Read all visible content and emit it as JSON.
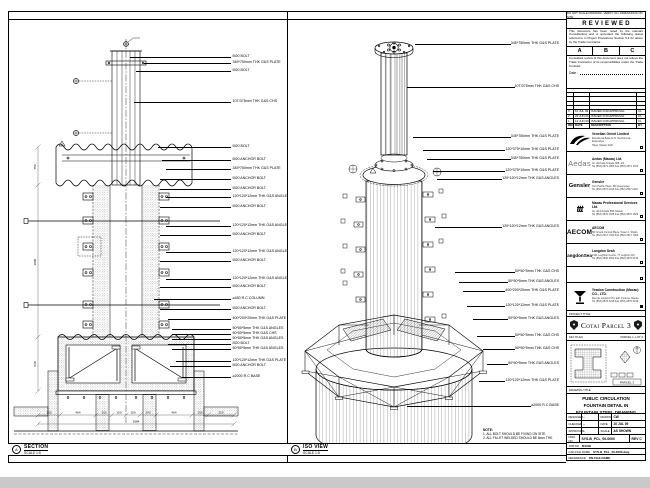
{
  "sheet": {
    "top_note": "DO NOT SCALE DRAWING. VERIFY ALL DIMENSIONS ON SITE.",
    "left_view": {
      "ref": "A",
      "label": "SECTION",
      "scale": "SCALE 1:5",
      "rev_triangle": "3",
      "callouts": [
        "M20 BOLT",
        "345*750mm THK G&S PLATE",
        "M20 BOLT",
        "10T/375mm THK G&S CHS",
        "M20 BOLT",
        "M20 ANCHOR BOLT",
        "345*750mm THK G&S PLATE",
        "M20 ANCHOR BOLT",
        "M20 ANCHOR BOLT",
        "120*120*12mm THK G&S ANGLES",
        "M20 ANCHOR BOLT",
        "120*120*12mm THK G&S ANGLES",
        "M20 ANCHOR BOLT",
        "120*120*12mm THK G&S ANGLES",
        "M20 ANCHOR BOLT",
        "120*120*12mm THK G&S ANGLES",
        "M20 ANCHOR BOLT",
        "⌀450 R.C COLUMN",
        "M20 ANCHOR BOLT",
        "400*200*20mm THK G&S PLATE",
        "50*50*5mm THK G&S ANGLES",
        "50*50*5mm THK G&S CHS",
        "50*50*5mm THK G&S ANGLES",
        "M20 BOLT",
        "50*50*5mm THK G&S ANGLES",
        "120*120*12mm THK G&S PLATE",
        "M20 ANCHOR BOLT",
        "⌀2000 R.C BASE"
      ],
      "dim_bottom": [
        "200",
        "464",
        "200",
        "150",
        "150",
        "200",
        "464",
        "200",
        "250"
      ],
      "dim_total": "2584",
      "dim_side": [
        "750",
        "3000",
        "540"
      ]
    },
    "iso_view": {
      "ref": "B",
      "label": "ISO VIEW",
      "scale": "SCALE 1:5",
      "note_title": "NOTE:",
      "notes": [
        "1. ALL BOLT SHOULD BE FIXING ON SITE.",
        "2. ALL FILLET WELDED SHOULD BE 6mm THK."
      ],
      "callouts": [
        "345*750mm THK G&S PLATE",
        "10T/375mm THK G&S CHS",
        "345*750mm THK G&S PLATE",
        "120*375*10mm THK G&S PLATE",
        "345*750mm THK G&S PLATE",
        "120*375*10mm THK G&S PLATE",
        "120*120*12mm THK G&S ANGLES",
        "120*120*12mm THK G&S ANGLES",
        "50*50*5mm THK G&S CHS",
        "50*50*5mm THK G&S ANGLES",
        "400*200*20mm THK G&S PLATE",
        "120*120*12mm THK G&S PLATE",
        "50*50*5mm THK G&S ANGLES",
        "50*50*5mm THK G&S CHS",
        "50*50*5mm THK G&S CHS",
        "50*50*5mm THK G&S ANGLES",
        "120*120*12mm THK G&S PLATE",
        "⌀2000 R.C BASE"
      ]
    },
    "title_block": {
      "reviewed": {
        "title": "REVIEWED",
        "para1": "This document has been noted by the relevant Consultant(s) and is accorded the following status referred to in Project Procedures Section 5.4 for action by the Trade Contractor.",
        "grades": [
          "A",
          "B",
          "C"
        ],
        "para2": "Consultant review of this document does not relieve the Trade Contractor of its responsibilities under the Trade Contract.",
        "date_label": "Date :"
      },
      "revision_table": {
        "headers": [
          "REV",
          "DATE",
          "DESCRIPTION",
          "BY"
        ],
        "rows": [
          [
            "3",
            "10 JUL 09",
            "ISSUED FOR APPROVAL",
            "CL"
          ],
          [
            "2",
            "26 JUN 09",
            "ISSUED FOR APPROVAL",
            "CL"
          ],
          [
            "1",
            "12 JUN 09",
            "ISSUED FOR APPROVAL",
            "CL"
          ]
        ]
      },
      "companies": [
        {
          "logo_text": "",
          "name": "Venetian Orient Limited",
          "line1": "Estrada da Baía de N. Senhora da Esperança",
          "line2": "Taipa, Macau SAR"
        },
        {
          "logo_text": "Aedas",
          "name": "Aedas (Macau) Ltd.",
          "line1": "Av. da Praia Grande 665, 2/F",
          "line2": "Tel (853) 2871 1800  Fax (853) 2871 1700"
        },
        {
          "logo_text": "Gensler",
          "name": "Gensler",
          "line1": "Two Pacific Place, 88 Queensway",
          "line2": "Tel (852) 2507 0118  Fax (852) 2507 0119"
        },
        {
          "logo_text": "ttt",
          "name": "Macau Professional Services Ltd.",
          "line1": "Av. da Amizade 555, Macau",
          "line2": "Tel (853) 2870 1628  Fax (853) 2870 1629"
        },
        {
          "logo_text": "AECOM",
          "name": "AECOM",
          "line1": "8/F Grand Central Plaza, Tower 2, Shatin",
          "line2": "Tel (852) 2317 7000  Fax (852) 2317 7009"
        },
        {
          "logo_text": "LangdonSeah",
          "name": "Langdon Seah",
          "line1": "2101 Leighton Centre, 77 Leighton Rd",
          "line2": "Tel (852) 2830 3500  Fax (852) 2576 0416"
        }
      ],
      "contractor": {
        "name": "Yeadon Construction (Macau) CO., LTD.",
        "line1": "Rua de Londres 573, Edf. Fortuna, Macau",
        "line2": "Tel (853) 2875 3218  Fax (853) 2875 3219"
      },
      "project_title_label": "PROJECT TITLE",
      "project_title": "Cotai Parcel 3",
      "key_plan": {
        "label": "KEY PLAN",
        "right_label": "PARCEL 1, LOT 2",
        "caption": "PARCEL 3"
      },
      "drawing_title_label": "DRAWING TITLE",
      "drawing_title": [
        "PUBLIC CIRCULATION",
        "FOUNTAIN DETAIL IN",
        "FOUNTAIN STEEL DRAWING"
      ],
      "info": {
        "designed_label": "DESIGNED",
        "designed": "-",
        "drawn_label": "DRAWN",
        "drawn": "CW",
        "checked_label": "CHECKED",
        "checked": "-",
        "date_label": "DATE",
        "date": "10 JUL 09",
        "approved_label": "APPROVED",
        "approved": "-",
        "scale_label": "SCALE",
        "scale": "AS SHOWN",
        "dwg_label": "DWG NO",
        "dwg_no": "SYS-B_PCL_00-0000",
        "rev": "REV C",
        "job_label": "JOB NO",
        "job_no": "M1049",
        "cad_label": "CAD FILE NAME",
        "cad_file": "SYS-B_PCL_00-0000.dwg",
        "ref_label": "REFERENCE",
        "ref": "ON FILE NAME"
      }
    }
  }
}
